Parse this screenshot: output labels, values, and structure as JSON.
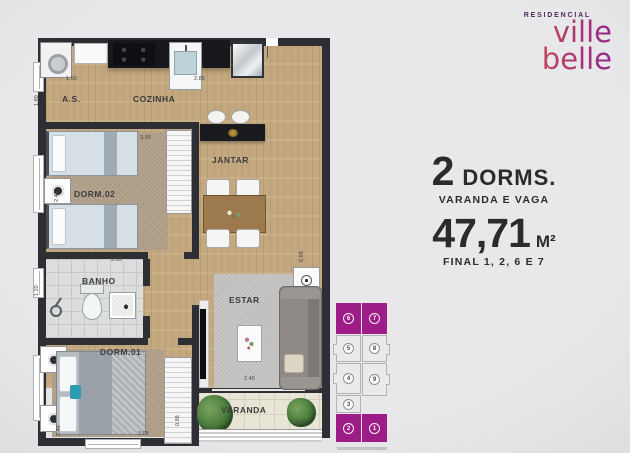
{
  "brand": {
    "kicker": "RESIDENCIAL",
    "name_line1": "ville",
    "name_line2": "belle",
    "gradient_from": "#e05a44",
    "gradient_to": "#93268b"
  },
  "info": {
    "dorms_value": "2",
    "dorms_label": "DORMS.",
    "features": "VARANDA E VAGA",
    "area_value": "47,71",
    "area_unit": "M²",
    "finals": "FINAL 1, 2, 6 E 7"
  },
  "plan": {
    "labels": {
      "as": "A.S.",
      "cozinha": "COZINHA",
      "jantar": "JANTAR",
      "dorm2": "DORM.02",
      "banho": "BANHO",
      "estar": "ESTAR",
      "dorm1": "DORM.01",
      "varanda": "VARANDA"
    },
    "dims": {
      "as_w": "1.50",
      "as_h": "1.60",
      "cozinha_w": "2.85",
      "dorm2_w": "3.55",
      "dorm2_h": "2.43",
      "banho_w": "2.03",
      "banho_h": "1.20",
      "estar_w": "2.40",
      "right_h": "6.88",
      "dorm1_w": "3.05",
      "dorm1_h": "2.40",
      "varanda_w": "2.40",
      "varanda_h": "0.88"
    }
  },
  "keyplan": {
    "highlight": "#9e1c87",
    "left": [
      {
        "label": "6",
        "hl": true
      },
      {
        "label": "5",
        "hl": false
      },
      {
        "label": "4",
        "hl": false
      },
      {
        "label": "3",
        "hl": false
      },
      {
        "label": "2",
        "hl": true
      }
    ],
    "right": [
      {
        "label": "7",
        "hl": true
      },
      {
        "label": "8",
        "hl": false
      },
      {
        "label": "9",
        "hl": false
      },
      {
        "label": "1",
        "hl": true
      }
    ]
  }
}
